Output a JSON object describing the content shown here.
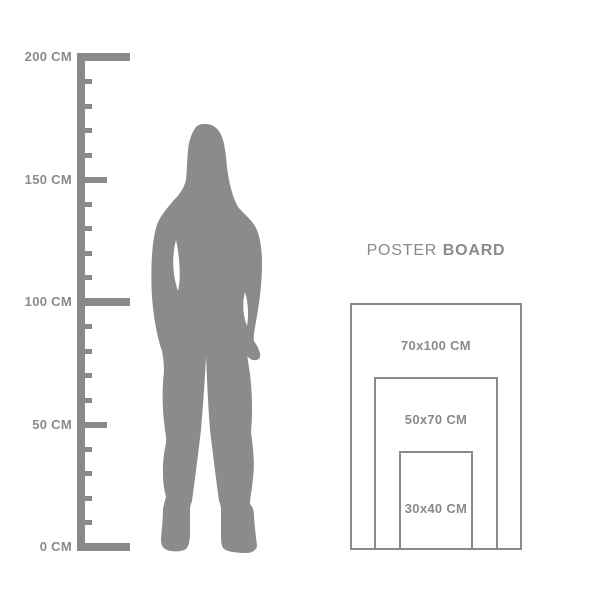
{
  "colors": {
    "gray": "#8a8a8a",
    "silhouette_gray": "#8b8b8b",
    "background": "#ffffff"
  },
  "ruler": {
    "unit": "CM",
    "labels": [
      {
        "cm": 200,
        "text": "200 CM"
      },
      {
        "cm": 150,
        "text": "150 CM"
      },
      {
        "cm": 100,
        "text": "100 CM"
      },
      {
        "cm": 50,
        "text": "50 CM"
      },
      {
        "cm": 0,
        "text": "0 CM"
      }
    ],
    "ticks": [
      {
        "cm": 200,
        "size": "major"
      },
      {
        "cm": 190,
        "size": "minor"
      },
      {
        "cm": 180,
        "size": "minor"
      },
      {
        "cm": 170,
        "size": "minor"
      },
      {
        "cm": 160,
        "size": "minor"
      },
      {
        "cm": 150,
        "size": "medium"
      },
      {
        "cm": 140,
        "size": "minor"
      },
      {
        "cm": 130,
        "size": "minor"
      },
      {
        "cm": 120,
        "size": "minor"
      },
      {
        "cm": 110,
        "size": "minor"
      },
      {
        "cm": 100,
        "size": "major"
      },
      {
        "cm": 90,
        "size": "minor"
      },
      {
        "cm": 80,
        "size": "minor"
      },
      {
        "cm": 70,
        "size": "minor"
      },
      {
        "cm": 60,
        "size": "minor"
      },
      {
        "cm": 50,
        "size": "medium"
      },
      {
        "cm": 40,
        "size": "minor"
      },
      {
        "cm": 30,
        "size": "minor"
      },
      {
        "cm": 20,
        "size": "minor"
      },
      {
        "cm": 10,
        "size": "minor"
      },
      {
        "cm": 0,
        "size": "major"
      }
    ]
  },
  "poster_board": {
    "title": {
      "light": "POSTER",
      "bold": "BOARD"
    },
    "sizes": [
      {
        "width_cm": 70,
        "height_cm": 100,
        "label": "70x100 CM"
      },
      {
        "width_cm": 50,
        "height_cm": 70,
        "label": "50x70 CM"
      },
      {
        "width_cm": 30,
        "height_cm": 40,
        "label": "30x40 CM"
      }
    ]
  }
}
